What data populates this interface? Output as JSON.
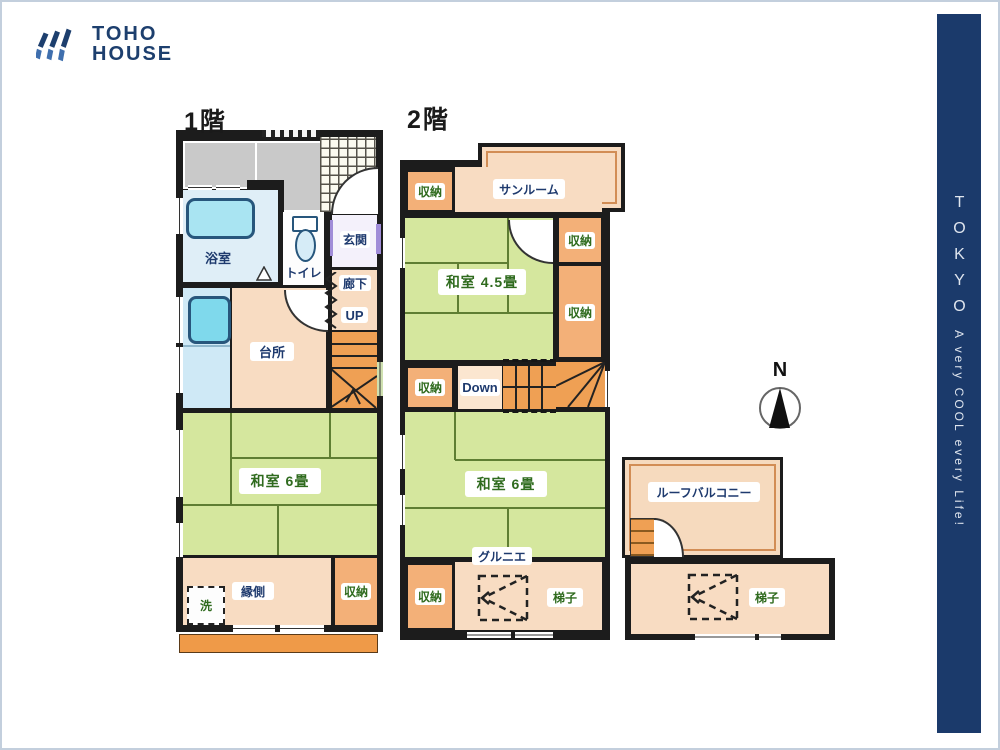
{
  "logo": {
    "line1": "TOHO",
    "line2": "HOUSE"
  },
  "sidebar": {
    "title": "TOKYO",
    "tagline": "A very COOL every Life!"
  },
  "compass": {
    "north": "N"
  },
  "floor1": {
    "title": "1階",
    "rooms": {
      "bath": "浴室",
      "toilet": "トイレ",
      "entrance": "玄関",
      "hallway": "廊下",
      "up": "UP",
      "kitchen": "台所",
      "tatami6": "和室 6畳",
      "engawa": "縁側",
      "storage": "収納",
      "wash": "洗"
    }
  },
  "floor2": {
    "title": "2階",
    "rooms": {
      "sunroom": "サンルーム",
      "tatami45": "和室 4.5畳",
      "tatami6": "和室 6畳",
      "down": "Down",
      "grenier": "グルニエ",
      "ladder": "梯子"
    },
    "storage_labels": [
      "収納",
      "収納",
      "収納",
      "収納",
      "収納"
    ]
  },
  "roof": {
    "balcony": "ルーフバルコニー",
    "ladder": "梯子"
  },
  "colors": {
    "wall": "#1c1c1c",
    "tatami_green": "#d5e79e",
    "room_peach": "#f8dcc2",
    "storage_orange": "#f3b078",
    "stair_orange": "#efa054",
    "bath_blue": "#dfeef7",
    "tub_cyan": "#a9e4f2",
    "gray_area": "#c9c9c9",
    "label_navy": "#1e3a6e",
    "label_green": "#2f6b1e",
    "brand_navy": "#1d3f6e",
    "sidebar_navy": "#1b3a6b"
  }
}
